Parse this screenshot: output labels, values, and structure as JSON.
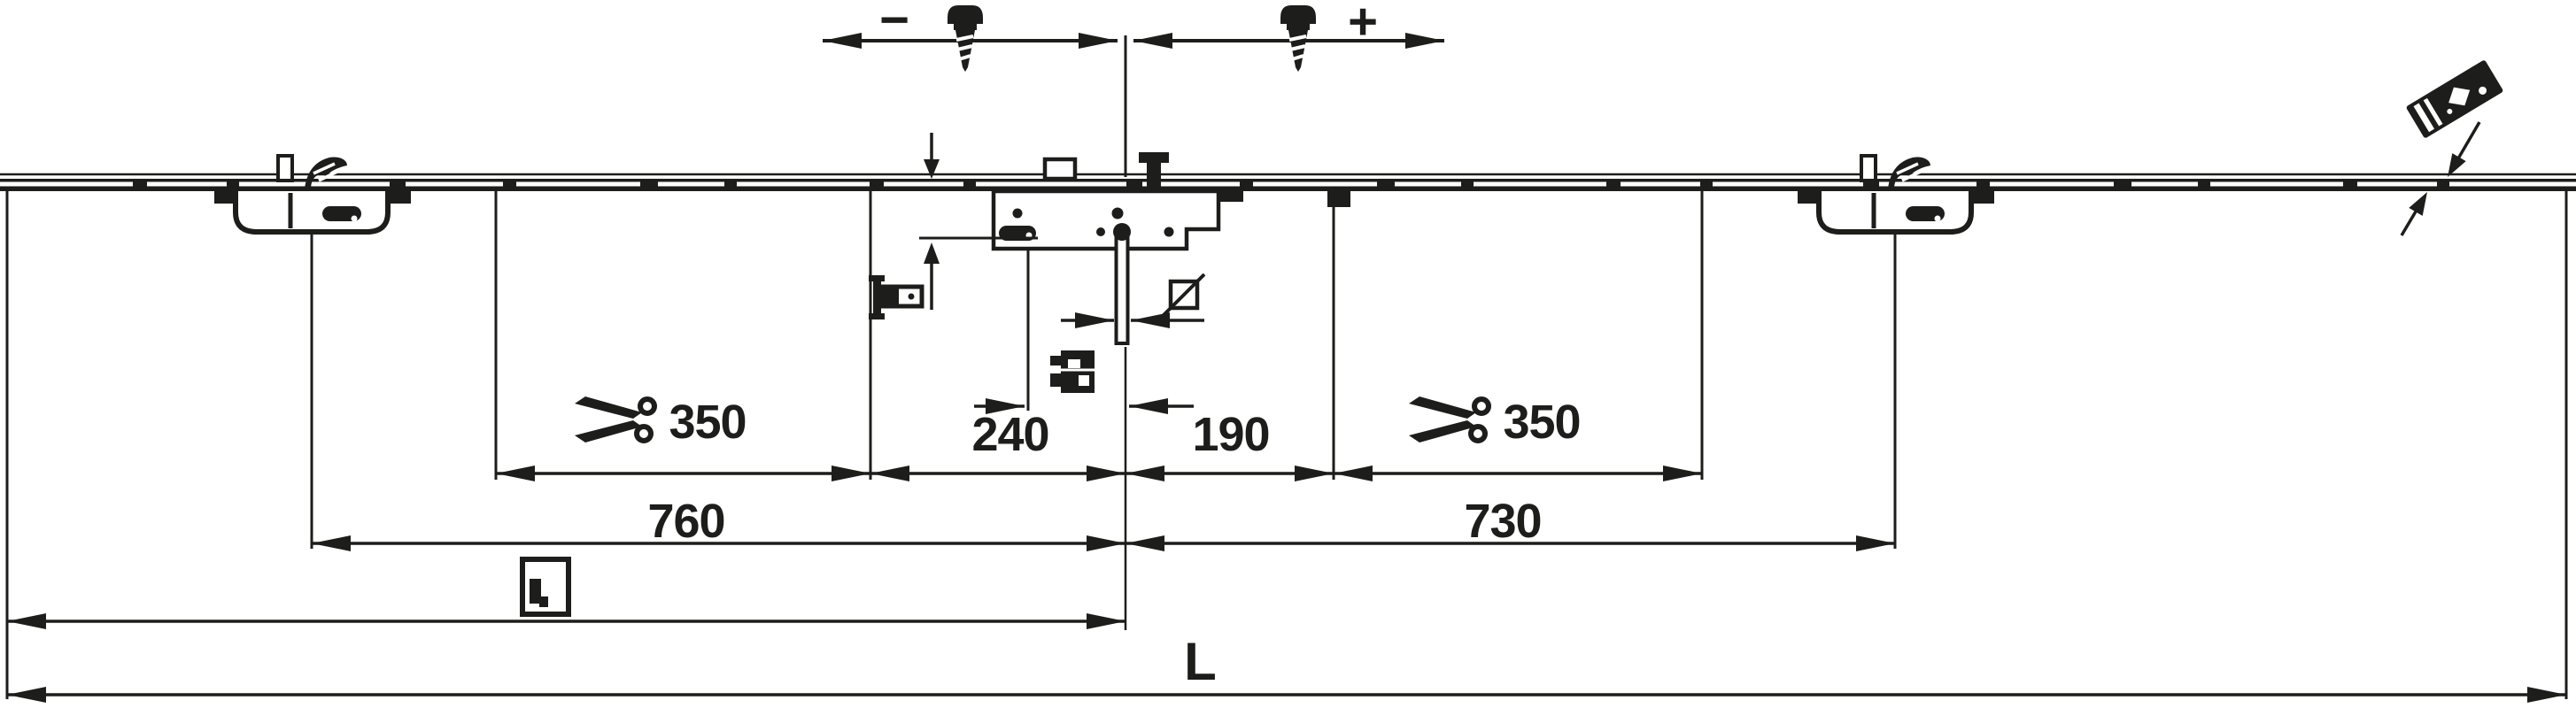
{
  "drawing": {
    "type": "technical-dimension-drawing",
    "subject": "Espagnolette multi-point lock rail with centre gearbox, two keepers, adjustment screws and dimension chains",
    "ink_color": "#1d1d1b",
    "background_color": "#ffffff",
    "labels": {
      "minus": "−",
      "plus": "+"
    },
    "dims": {
      "cut_left": "350",
      "mid_left": "240",
      "mid_right": "190",
      "cut_right": "350",
      "keeper_left": "760",
      "keeper_right": "730",
      "total": "L"
    },
    "icons": {
      "scissors": "cut-to-length",
      "screw": "adjustment-screw",
      "square_spindle": "square-with-diagonal",
      "window_handle": "window-with-handle",
      "profile_groove": "frame-groove-section",
      "profile_section": "sash-profile-section",
      "striker_plate": "tilted-striker-plate-with-insert-arrows"
    }
  }
}
